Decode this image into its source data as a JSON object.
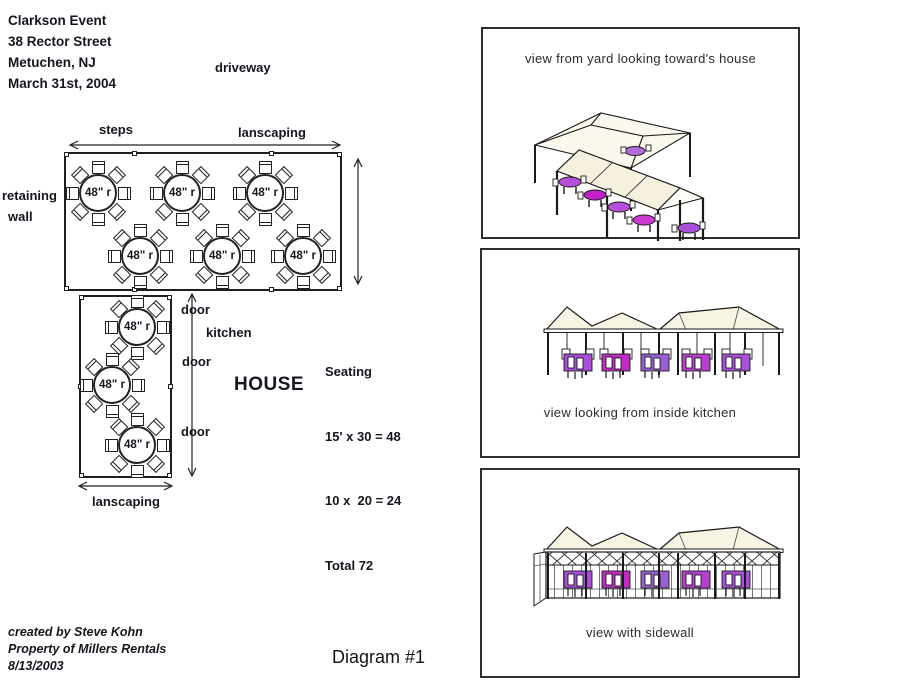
{
  "header": {
    "lines": [
      "Clarkson Event",
      "38 Rector Street",
      "Metuchen, NJ",
      "March 31st, 2004"
    ]
  },
  "plan": {
    "driveway_label": "driveway",
    "steps_label": "steps",
    "landscaping_top_label": "lanscaping",
    "retaining_wall_line1": "retaining",
    "retaining_wall_line2": "wall",
    "table_label": "48\" r",
    "door_label": "door",
    "kitchen_label": "kitchen",
    "house_label": "HOUSE",
    "landscaping_bottom_label": "lanscaping",
    "seating": {
      "title": "Seating",
      "line1": "15' x 30 = 48",
      "line2": "10 x  20 = 24",
      "total_line": "Total 72"
    }
  },
  "views": {
    "yard": {
      "caption": "view from yard looking toward's house"
    },
    "kitchen": {
      "caption": "view looking from inside kitchen"
    },
    "sidewall": {
      "caption": "view with sidewall"
    }
  },
  "footer": {
    "credit_lines": [
      "created by Steve Kohn",
      "Property of Millers Rentals",
      "8/13/2003"
    ],
    "diagram_label": "Diagram #1"
  },
  "colors": {
    "ink": "#16161f",
    "canopy": "#f6f3e2",
    "table_purple": "#b44bd8",
    "table_magenta": "#c524c8"
  }
}
